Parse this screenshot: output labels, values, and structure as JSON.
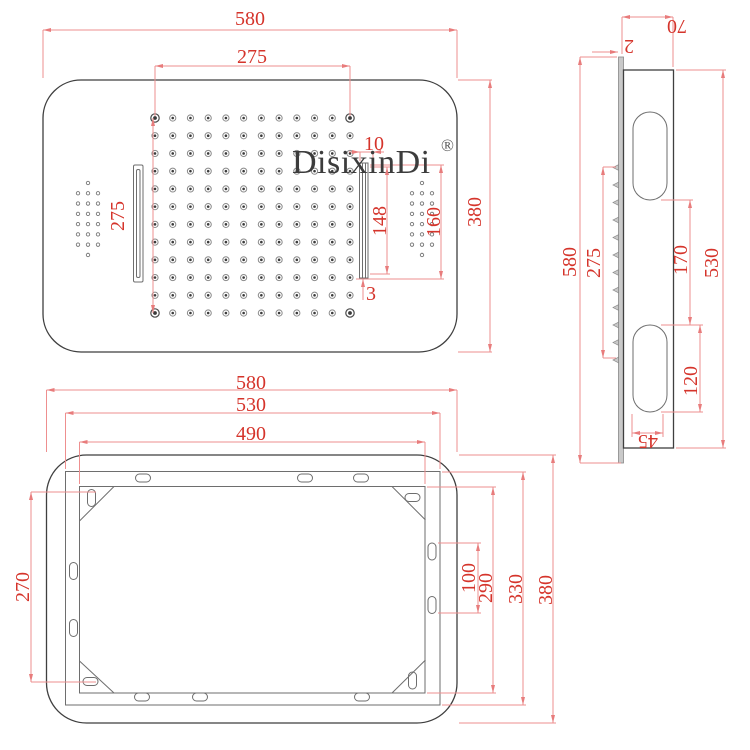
{
  "drawing": {
    "brand": "DisixinDi",
    "registered_mark": "®",
    "colors": {
      "dimension_red": "#d5342b",
      "extension_red": "#ee8f8f",
      "ink": "#3f3f3f"
    },
    "views": {
      "front": {
        "dims": {
          "width_overall": "580",
          "nozzle_span_h": "275",
          "nozzle_span_v": "275",
          "height_overall": "380",
          "slot_width": "10",
          "slot_length": "148",
          "slot_recess_length": "160",
          "slot_offset": "3"
        }
      },
      "side": {
        "dims": {
          "depth": "70",
          "panel_thickness": "2",
          "length_overall": "580",
          "nozzle_span": "275",
          "slot_gap": "170",
          "body_length": "530",
          "slot_length": "120",
          "slot_width": "45"
        }
      },
      "back": {
        "dims": {
          "width_overall": "580",
          "frame_width": "530",
          "frame_inner_width": "490",
          "mount_span": "270",
          "slot_pitch": "100",
          "frame_inner_height": "290",
          "frame_height": "330",
          "height_overall": "380"
        }
      }
    }
  }
}
